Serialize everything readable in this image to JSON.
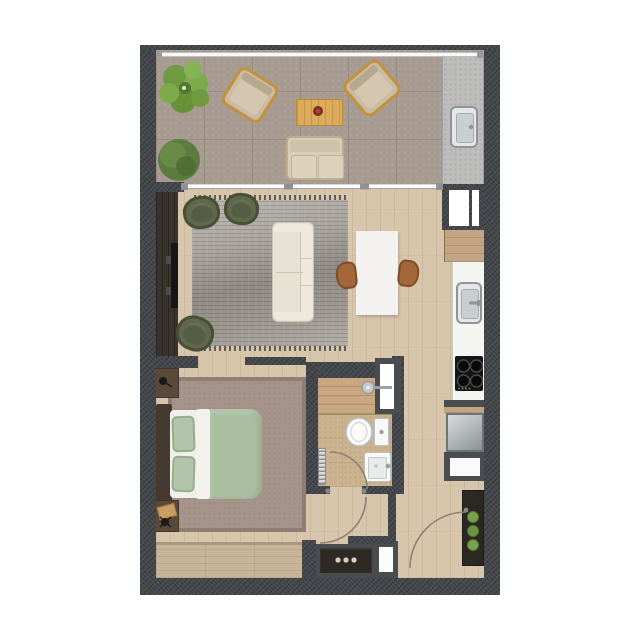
{
  "meta": {
    "type": "architectural-floor-plan",
    "view": "top-down",
    "unit": "one-bedroom-apartment",
    "visible_text": "none"
  },
  "palette": {
    "wall": "#43464a",
    "terrace": "#a79a90",
    "concrete": "#bdbdbb",
    "wood": "#d8c6ac",
    "cabinet-wood": "#c3a483",
    "rug": "#aaa69f",
    "olive": "#5f684b",
    "olive-dark": "#474f36",
    "sofa": "#e8e2d5",
    "sofa-edge": "#cdc5b4",
    "table-white": "#f3f2f0",
    "chair-brown": "#a4673a",
    "counter": "#f4f4f1",
    "steel": "#9aa0a3",
    "cooktop": "#141414",
    "bed-green": "#a9bfa0",
    "linen": "#f1efe9",
    "headboard": "#463a30",
    "nightstand": "#5a4939",
    "bedroom-rug": "#a5948a",
    "wardrobe": "#c8b599",
    "bath-tile": "#ccb38f",
    "shower-wood": "#c8a781",
    "fixture": "#f9f9f8",
    "fixture-edge": "#bcc0c2",
    "console": "#2e2923",
    "plant": "#79a24e",
    "plant-dark": "#4e7a2c",
    "accent-wood": "#dcab5c",
    "arc": "#8d8174",
    "balustrade": "#f8f8f8"
  },
  "rooms": [
    {
      "name": "terrace",
      "features": [
        "balustrade",
        "outdoor-kitchen-counter"
      ]
    },
    {
      "name": "living-room",
      "features": [
        "media-wall",
        "area-rug"
      ]
    },
    {
      "name": "dining-area",
      "features": []
    },
    {
      "name": "kitchen",
      "features": [
        "counter-run"
      ]
    },
    {
      "name": "bedroom",
      "features": [
        "area-rug",
        "wardrobe"
      ]
    },
    {
      "name": "bathroom",
      "features": [
        "walk-in-shower",
        "towel-radiator"
      ]
    },
    {
      "name": "entry-hallway",
      "features": [
        "console",
        "plant-shelf"
      ]
    }
  ],
  "furniture": [
    {
      "room": "terrace",
      "item": "potted-plant-large"
    },
    {
      "room": "terrace",
      "item": "shrub-planter"
    },
    {
      "room": "terrace",
      "item": "lounge-armchair",
      "count": 2
    },
    {
      "room": "terrace",
      "item": "wood-coffee-table"
    },
    {
      "room": "terrace",
      "item": "outdoor-sofa"
    },
    {
      "room": "terrace",
      "item": "outdoor-sink"
    },
    {
      "room": "living-room",
      "item": "tv-media-panel"
    },
    {
      "room": "living-room",
      "item": "barrel-armchair-olive",
      "count": 3
    },
    {
      "room": "living-room",
      "item": "three-seat-sofa-cream"
    },
    {
      "room": "dining-area",
      "item": "dining-table-white"
    },
    {
      "room": "dining-area",
      "item": "dining-chair-walnut",
      "count": 2
    },
    {
      "room": "kitchen",
      "item": "sink-stainless"
    },
    {
      "room": "kitchen",
      "item": "cooktop-4-burner"
    },
    {
      "room": "kitchen",
      "item": "refrigerator"
    },
    {
      "room": "kitchen",
      "item": "appliance-niche"
    },
    {
      "room": "bedroom",
      "item": "double-bed-green-duvet"
    },
    {
      "room": "bedroom",
      "item": "nightstand",
      "count": 2
    },
    {
      "room": "bedroom",
      "item": "table-lamp",
      "count": 2
    },
    {
      "room": "bedroom",
      "item": "wardrobe-builtin"
    },
    {
      "room": "bathroom",
      "item": "toilet"
    },
    {
      "room": "bathroom",
      "item": "washbasin"
    },
    {
      "room": "bathroom",
      "item": "shower-head"
    },
    {
      "room": "bathroom",
      "item": "glass-niche"
    },
    {
      "room": "entry-hallway",
      "item": "console-dresser-3-knobs"
    },
    {
      "room": "entry-hallway",
      "item": "plant-shelf-3-pots"
    }
  ],
  "doors": [
    {
      "name": "sliding-terrace-door",
      "type": "sliding-glass"
    },
    {
      "name": "bathroom-door",
      "type": "hinged",
      "swing": "into-bathroom"
    },
    {
      "name": "bedroom-door",
      "type": "hinged",
      "swing": "into-hallway"
    },
    {
      "name": "entry-door",
      "type": "hinged",
      "swing": "into-hallway"
    }
  ],
  "windows": [
    {
      "name": "kitchen-window",
      "panes": 2
    }
  ]
}
